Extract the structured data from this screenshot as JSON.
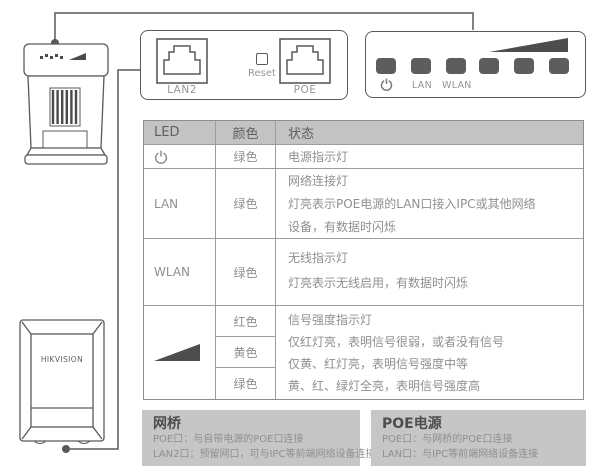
{
  "colors": {
    "outline": "#5a5a5a",
    "table_border": "#9d9d9d",
    "header_bg": "#c3c3c3",
    "section_bg": "#c6c6c6",
    "body_text": "#8f8f8f",
    "led_fill": "#5d5d5d",
    "wedge_fill": "#4d4d4d"
  },
  "port_panel": {
    "lan2_label": "LAN2",
    "reset_label": "Reset",
    "poe_label": "POE"
  },
  "led_panel": {
    "lan_label": "LAN",
    "wlan_label": "WLAN"
  },
  "device_front": {
    "brand": "HIKVISION"
  },
  "table": {
    "headers": {
      "led": "LED",
      "color": "颜色",
      "status": "状态"
    },
    "rows": {
      "power": {
        "color": "绿色",
        "status": "电源指示灯"
      },
      "lan": {
        "label": "LAN",
        "color": "绿色",
        "status": [
          "网络连接灯",
          "灯亮表示POE电源的LAN口接入IPC或其他网络",
          "设备，有数据时闪烁"
        ]
      },
      "wlan": {
        "label": "WLAN",
        "color": "绿色",
        "status": [
          "无线指示灯",
          "灯亮表示无线启用，有数据时闪烁"
        ]
      },
      "signal": {
        "colors": [
          "红色",
          "黄色",
          "绿色"
        ],
        "status": [
          "信号强度指示灯",
          "仅红灯亮，表明信号很弱，或者没有信号",
          "仅黄、红灯亮，表明信号强度中等",
          "黄、红、绿灯全亮，表明信号强度高"
        ]
      }
    }
  },
  "sections": {
    "bridge": {
      "title": "网桥",
      "lines": [
        "POE口：与自带电源的POE口连接",
        "LAN2口：预留网口，可与IPC等前端网络设备连接"
      ]
    },
    "poe": {
      "title": "POE电源",
      "lines": [
        "POE口：与网桥的POE口连接",
        "LAN口：与IPC等前端网络设备连接"
      ]
    }
  }
}
